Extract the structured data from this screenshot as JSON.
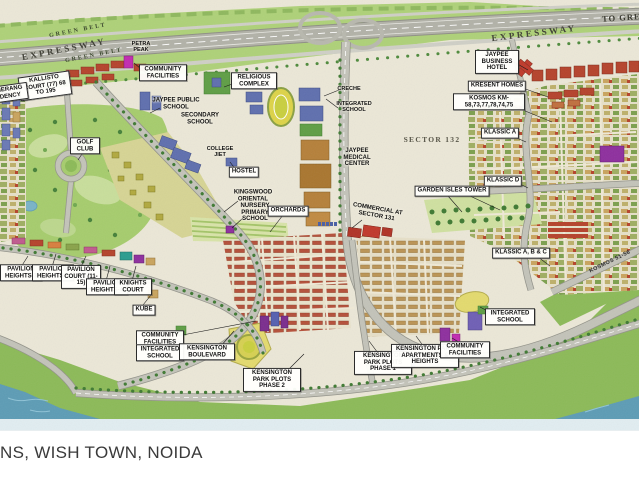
{
  "caption": {
    "text": "NS, WISH TOWN, NOIDA"
  },
  "map": {
    "background_color": "#ebe7d7",
    "colors": {
      "green_belt": "#aed178",
      "golf_green": "#a6cc6d",
      "road_gray": "#c3c3b9",
      "water_blue": "#5d9cb5",
      "red_housing": "#b5432c",
      "tan_housing": "#bb9455",
      "school_blue": "#5f6fae",
      "facility_magenta": "#c22bb1",
      "field_yellow": "#e3da6e"
    },
    "labels": [
      {
        "id": "green-belt-upper",
        "text": "GREEN BELT",
        "x": 78,
        "y": 31,
        "style": "belt",
        "rot": -11
      },
      {
        "id": "expressway-left",
        "text": "EXPRESSWAY",
        "x": 64,
        "y": 49,
        "style": "hwy",
        "rot": -11
      },
      {
        "id": "green-belt-lower",
        "text": "GREEN BELT",
        "x": 94,
        "y": 56,
        "style": "belt",
        "rot": -11
      },
      {
        "id": "petra-peak",
        "text": "PETRA PEAK",
        "x": 141,
        "y": 47,
        "style": "tinyplain",
        "w": 22
      },
      {
        "id": "expressway-right",
        "text": "EXPRESSWAY",
        "x": 534,
        "y": 33,
        "style": "hwy",
        "rot": -7
      },
      {
        "id": "to-greater-noida",
        "text": "TO GREATER NOIDA",
        "x": 653,
        "y": 16,
        "style": "hwy2",
        "rot": -4
      },
      {
        "id": "community-facilities-top",
        "text": "COMMUNITY FACILITIES",
        "x": 163,
        "y": 73,
        "style": "box",
        "w": 42
      },
      {
        "id": "kallisto-court",
        "text": "KALLISTO COURT (77) 68 TO 195",
        "x": 45,
        "y": 86,
        "style": "box",
        "w": 46,
        "rot": -8
      },
      {
        "id": "boomerang-residency",
        "text": "BOOMERANG RESIDENCY",
        "x": 3,
        "y": 94,
        "style": "box",
        "w": 44,
        "rot": -8
      },
      {
        "id": "jaypee-public-school",
        "text": "JAYPEE PUBLIC SCHOOL",
        "x": 176,
        "y": 104,
        "style": "plain",
        "w": 50
      },
      {
        "id": "secondary-school",
        "text": "SECONDARY SCHOOL",
        "x": 200,
        "y": 119,
        "style": "plain",
        "w": 46
      },
      {
        "id": "religious-complex",
        "text": "RELIGIOUS COMPLEX",
        "x": 254,
        "y": 81,
        "style": "box",
        "w": 40
      },
      {
        "id": "creche",
        "text": "CRECHE",
        "x": 349,
        "y": 89,
        "style": "tinyplain"
      },
      {
        "id": "integrated-school-top",
        "text": "INTEGRATED SCHOOL",
        "x": 354,
        "y": 107,
        "style": "tinyplain",
        "w": 42
      },
      {
        "id": "sector-132",
        "text": "SECTOR 132",
        "x": 432,
        "y": 140,
        "style": "sector"
      },
      {
        "id": "jaypee-medical-center",
        "text": "JAYPEE MEDICAL CENTER",
        "x": 357,
        "y": 158,
        "style": "plain",
        "w": 36
      },
      {
        "id": "college-jiet",
        "text": "COLLEGE JIET",
        "x": 220,
        "y": 152,
        "style": "tinyplain",
        "w": 32
      },
      {
        "id": "hostel",
        "text": "HOSTEL",
        "x": 244,
        "y": 172,
        "style": "box"
      },
      {
        "id": "kingswood-oriental",
        "text": "KINGSWOOD ORIENTAL",
        "x": 253,
        "y": 196,
        "style": "plain",
        "w": 46
      },
      {
        "id": "nursery-primary-school",
        "text": "NURSERY PRIMARY SCHOOL",
        "x": 255,
        "y": 213,
        "style": "plain",
        "w": 36
      },
      {
        "id": "orchards",
        "text": "ORCHARDS",
        "x": 288,
        "y": 211,
        "style": "box"
      },
      {
        "id": "jaypee-business-hotel",
        "text": "JAYPEE BUSINESS HOTEL",
        "x": 497,
        "y": 62,
        "style": "box",
        "w": 38
      },
      {
        "id": "kresent-homes",
        "text": "KRESENT HOMES",
        "x": 497,
        "y": 86,
        "style": "box",
        "w": 58
      },
      {
        "id": "kosmos-km",
        "text": "KOSMOS KM-58,73,77,78,74,75",
        "x": 489,
        "y": 102,
        "style": "box",
        "w": 66
      },
      {
        "id": "klassic-a",
        "text": "KLASSIC A",
        "x": 500,
        "y": 133,
        "style": "box"
      },
      {
        "id": "klassic-d",
        "text": "KLASSIC D",
        "x": 503,
        "y": 181,
        "style": "box"
      },
      {
        "id": "garden-isles-tower",
        "text": "GARDEN ISLES TOWER",
        "x": 452,
        "y": 191,
        "style": "box",
        "w": 72
      },
      {
        "id": "commercial-sector-131",
        "text": "COMMERCIAL AT SECTOR 131",
        "x": 377,
        "y": 213,
        "style": "plain",
        "w": 54,
        "rot": 10
      },
      {
        "id": "klassic-abc",
        "text": "KLASSIC A, B & C",
        "x": 521,
        "y": 253,
        "style": "box",
        "w": 62
      },
      {
        "id": "kosmos-51-56",
        "text": "KOSMOS 51-56",
        "x": 610,
        "y": 262,
        "style": "road",
        "rot": -26
      },
      {
        "id": "pavilion-heights-3",
        "text": "PAVILION HEIGHTS-3",
        "x": 21,
        "y": 273,
        "style": "box",
        "w": 36
      },
      {
        "id": "pavilion-heights-2",
        "text": "PAVILION HEIGHTS-2",
        "x": 53,
        "y": 273,
        "style": "box",
        "w": 36
      },
      {
        "id": "pavilion-court",
        "text": "PAVILION COURT (11-15)",
        "x": 81,
        "y": 277,
        "style": "box",
        "w": 34
      },
      {
        "id": "pavilion-heights-4",
        "text": "PAVILION HEIGHTS-4",
        "x": 107,
        "y": 287,
        "style": "box",
        "w": 36
      },
      {
        "id": "knights-court",
        "text": "KNIGHTS COURT",
        "x": 133,
        "y": 287,
        "style": "box",
        "w": 32
      },
      {
        "id": "kube",
        "text": "KUBE",
        "x": 144,
        "y": 310,
        "style": "box"
      },
      {
        "id": "community-facilities-bl",
        "text": "COMMUNITY FACILITIES",
        "x": 160,
        "y": 339,
        "style": "box",
        "w": 42
      },
      {
        "id": "integrated-school-bl",
        "text": "INTEGRATED SCHOOL",
        "x": 160,
        "y": 353,
        "style": "box",
        "w": 42
      },
      {
        "id": "kensington-boulevard",
        "text": "KENSINGTON BOULEVARD",
        "x": 207,
        "y": 352,
        "style": "box",
        "w": 50
      },
      {
        "id": "kensington-park-plots-2",
        "text": "KENSINGTON PARK PLOTS PHASE 2",
        "x": 272,
        "y": 380,
        "style": "box",
        "w": 52
      },
      {
        "id": "kensington-park-plots-1",
        "text": "KENSINGTON PARK PLOTS PHASE 1",
        "x": 383,
        "y": 363,
        "style": "box",
        "w": 52
      },
      {
        "id": "kensington-park-apartments",
        "text": "KENSINGTON PARK APARTMENTS & HEIGHTS",
        "x": 425,
        "y": 356,
        "style": "box",
        "w": 62
      },
      {
        "id": "community-facilities-br",
        "text": "COMMUNITY FACILITIES",
        "x": 465,
        "y": 350,
        "style": "box",
        "w": 44
      },
      {
        "id": "integrated-school-br",
        "text": "INTEGRATED SCHOOL",
        "x": 510,
        "y": 317,
        "style": "box",
        "w": 44
      },
      {
        "id": "golf-club",
        "text": "GOLF CLUB",
        "x": 85,
        "y": 146,
        "style": "box",
        "w": 24
      }
    ]
  }
}
